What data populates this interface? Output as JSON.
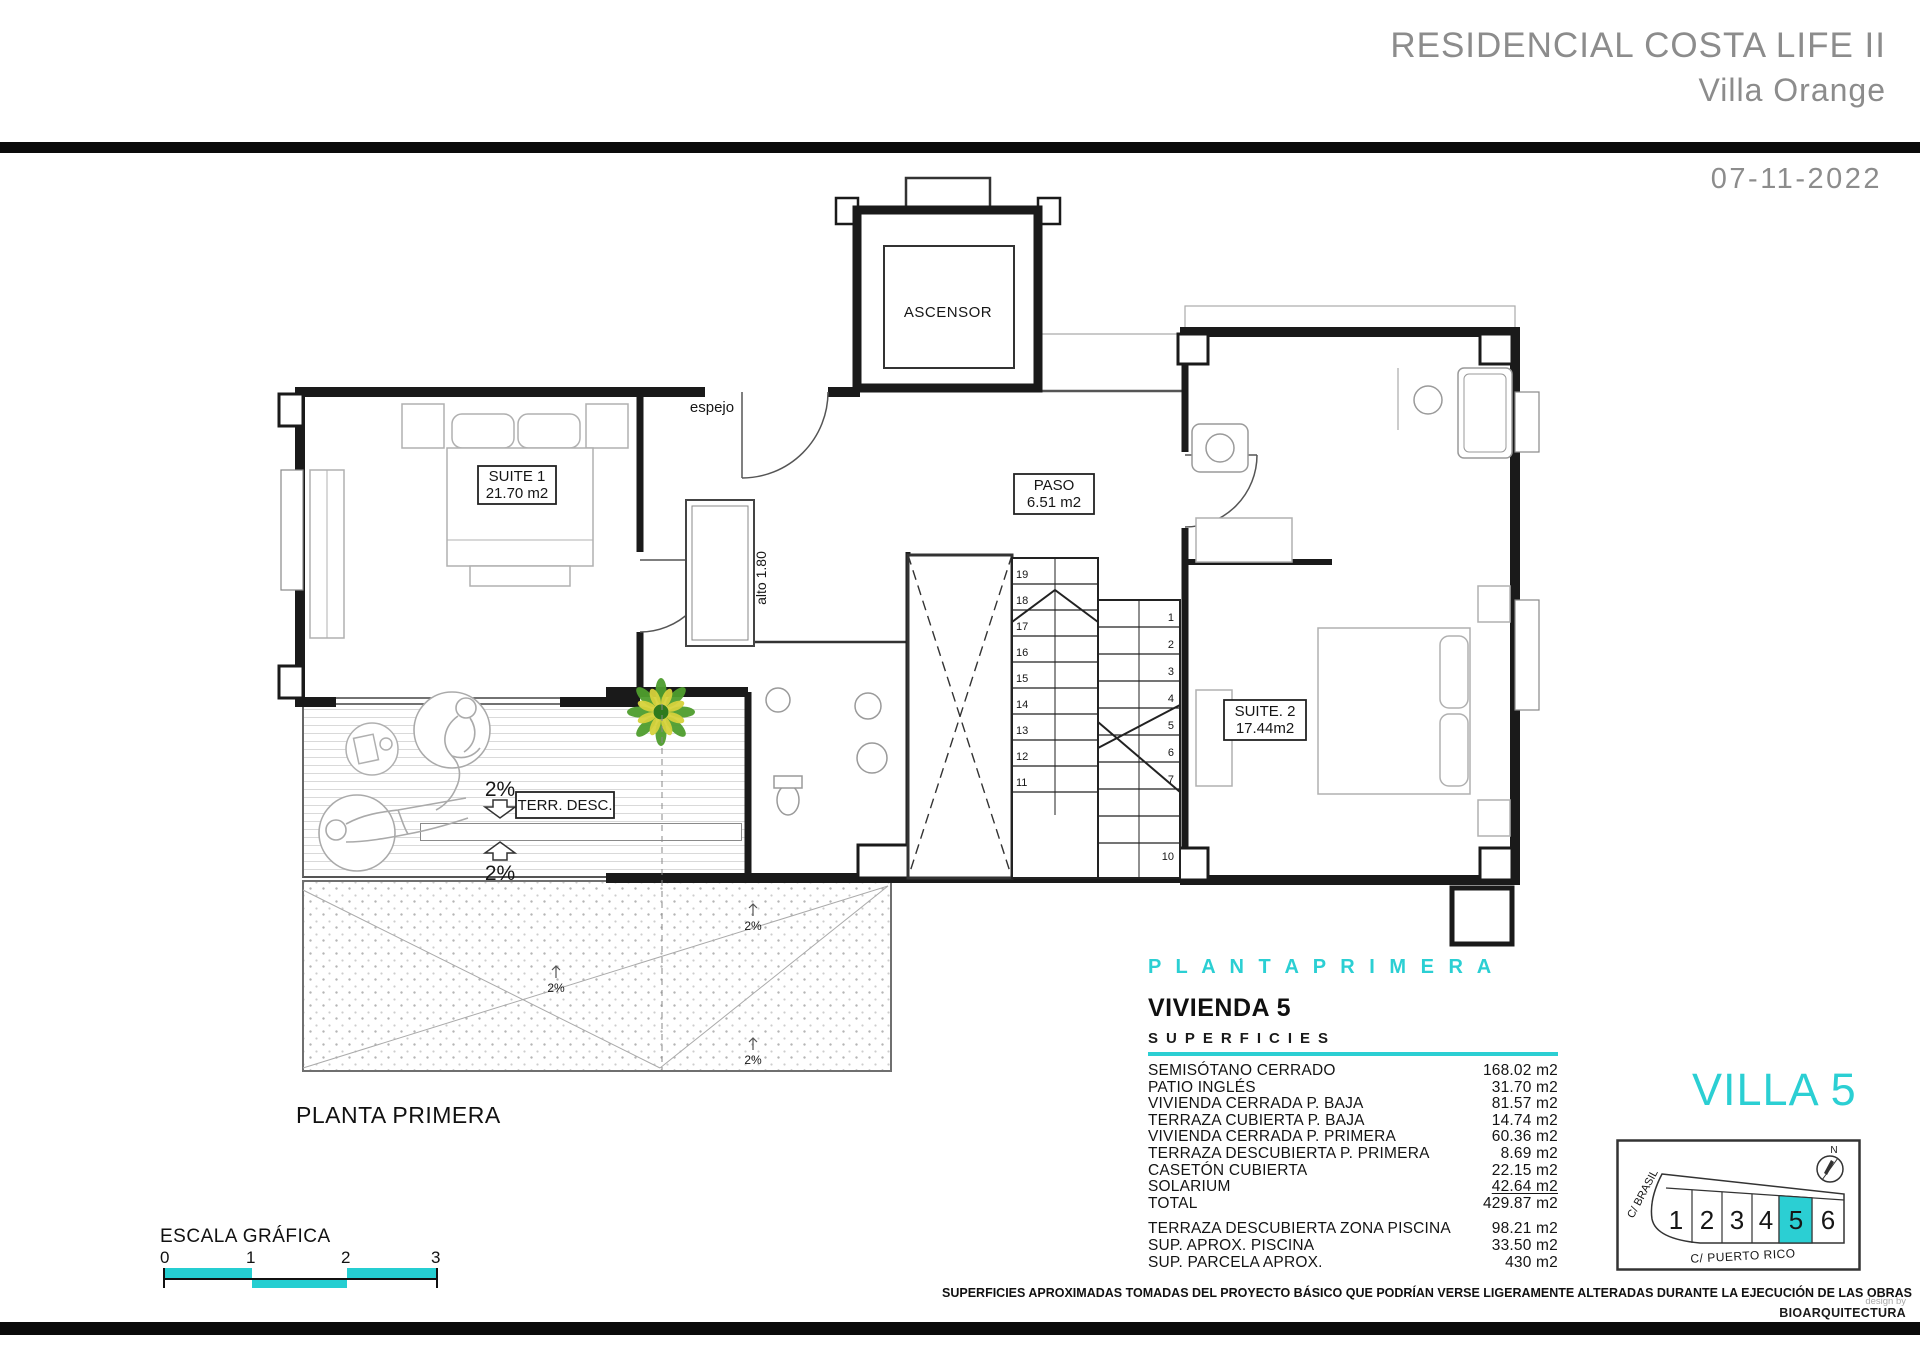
{
  "header": {
    "project_title": "RESIDENCIAL COSTA LIFE II",
    "subtitle": "Villa Orange",
    "date": "07-11-2022"
  },
  "plan": {
    "heading_cyan": "P L A N T A   P R I M E R A",
    "caption": "PLANTA PRIMERA",
    "labels": {
      "ascensor": "ASCENSOR",
      "espejo": "espejo",
      "alto": "alto 1.80",
      "suite1_name": "SUITE 1",
      "suite1_area": "21.70 m2",
      "paso_name": "PASO",
      "paso_area": "6.51 m2",
      "suite2_name": "SUITE. 2",
      "suite2_area": "17.44m2",
      "terraza": "TERR. DESC.",
      "slope": "2%"
    },
    "stairs": {
      "left": [
        "19",
        "18",
        "17",
        "16",
        "15",
        "14",
        "13",
        "12",
        "11"
      ],
      "right": [
        "1",
        "2",
        "3",
        "4",
        "5",
        "6",
        "7",
        "10"
      ]
    }
  },
  "summary": {
    "title": "VIVIENDA 5",
    "subtitle": "SUPERFICIES",
    "rows": [
      {
        "label": "SEMISÓTANO CERRADO",
        "value": "168.02 m2"
      },
      {
        "label": "PATIO INGLÉS",
        "value": "31.70 m2"
      },
      {
        "label": "VIVIENDA CERRADA P. BAJA",
        "value": "81.57 m2"
      },
      {
        "label": "TERRAZA CUBIERTA P. BAJA",
        "value": "14.74 m2"
      },
      {
        "label": "VIVIENDA CERRADA P. PRIMERA",
        "value": "60.36 m2"
      },
      {
        "label": "TERRAZA DESCUBIERTA P. PRIMERA",
        "value": "8.69 m2"
      },
      {
        "label": "CASETÓN CUBIERTA",
        "value": "22.15 m2"
      },
      {
        "label": "SOLARIUM",
        "value": "42.64 m2"
      },
      {
        "label": "TOTAL",
        "value": "429.87 m2"
      }
    ],
    "extra_rows": [
      {
        "label": "TERRAZA DESCUBIERTA  ZONA PISCINA",
        "value": "98.21 m2"
      },
      {
        "label": "SUP.  APROX.  PISCINA",
        "value": "33.50 m2"
      },
      {
        "label": "SUP. PARCELA APROX.",
        "value": "430 m2"
      }
    ]
  },
  "villa": {
    "title": "VILLA 5",
    "parcels": [
      "1",
      "2",
      "3",
      "4",
      "5",
      "6"
    ],
    "highlighted_parcel": "5",
    "street_left": "C/ BRASIL",
    "street_bottom": "C/ PUERTO RICO",
    "north_label": "N"
  },
  "scalebar": {
    "title": "ESCALA GRÁFICA",
    "ticks": [
      "0",
      "1",
      "2",
      "3"
    ]
  },
  "footer": {
    "disclaimer": "SUPERFICIES APROXIMADAS TOMADAS DEL PROYECTO BÁSICO QUE PODRÍAN VERSE LIGERAMENTE ALTERADAS DURANTE LA EJECUCIÓN DE LAS OBRAS",
    "design_by": "design by",
    "brand": "BIOARQUITECTURA"
  },
  "colors": {
    "accent": "#2BCFD3",
    "header_gray": "#8C8C8C",
    "wall_black": "#1A1A1A"
  }
}
